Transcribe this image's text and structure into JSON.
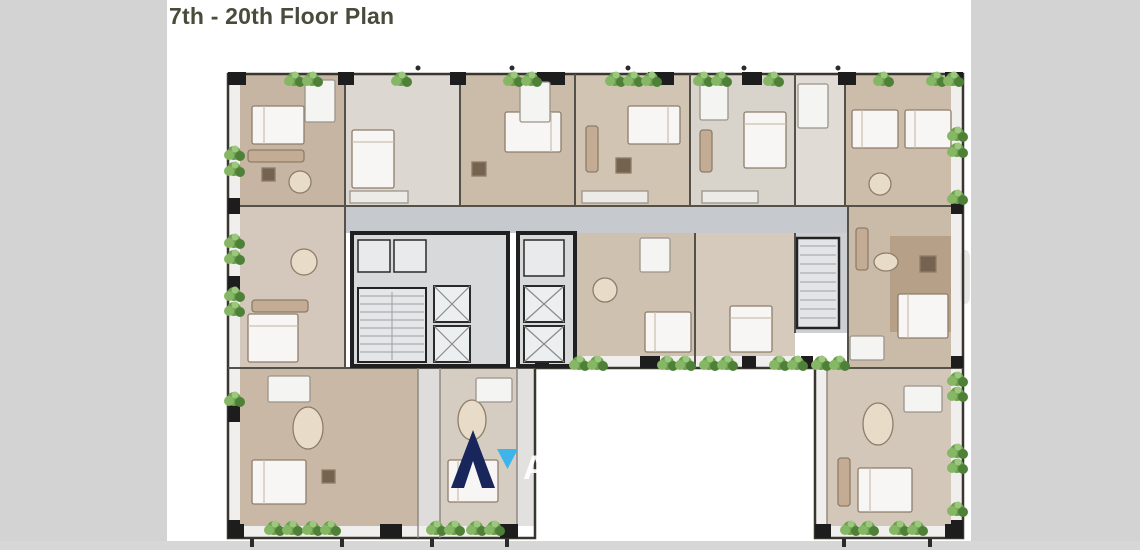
{
  "page": {
    "title": "7th - 20th Floor Plan",
    "background": "#ffffff",
    "gutter_color": "#d3d3d3",
    "title_color": "#4b4b3b"
  },
  "watermark": {
    "brand_text": "AccomAsia",
    "logo_navy": "#18265c",
    "logo_light_blue": "#3db5ea",
    "text_color": "#ffffff"
  },
  "floor_plan": {
    "caption": "7th - 20th Floor Plan",
    "kind": "architectural floor plan, H-shaped residential tower storey",
    "palette": {
      "wall_dark": "#1d1d1d",
      "wall_line": "#54504a",
      "floor_tan": "#c6b5a2",
      "floor_pale": "#dcd7d0",
      "corridor_grey": "#c6cace",
      "core_grey": "#d7d9db",
      "balcony_white": "#f0efed",
      "plant_green": "#6da04f",
      "bed_white": "#f7f6f4",
      "furniture_brown": "#8d7d69"
    }
  }
}
